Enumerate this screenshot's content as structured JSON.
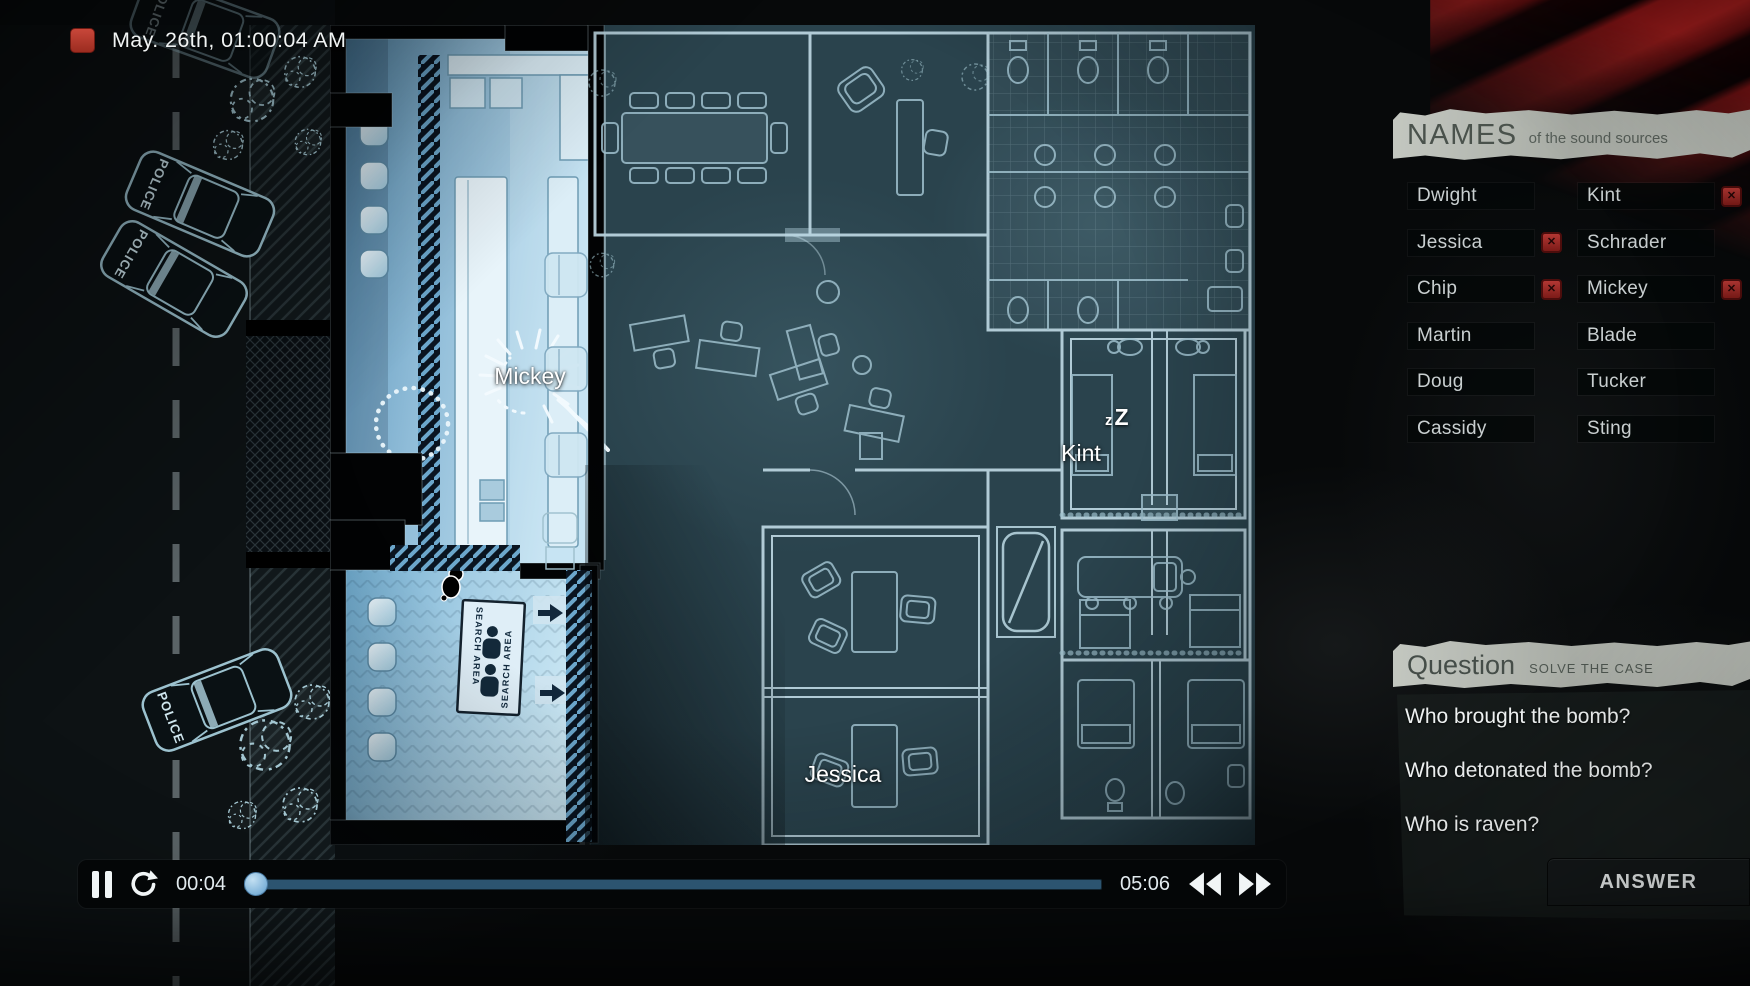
{
  "hud": {
    "timestamp": "May. 26th, 01:00:04 AM"
  },
  "map": {
    "police_text": "POLICE",
    "search_area_text": "SEARCH AREA",
    "labels": {
      "mickey": "Mickey",
      "kint": "Kint",
      "jessica": "Jessica"
    },
    "sleep_small": "z",
    "sleep_big": "Z"
  },
  "names_panel": {
    "title": "NAMES",
    "subtitle": "of the sound sources",
    "flag_icon": "✕",
    "items": [
      {
        "label": "Dwight",
        "flagged": false
      },
      {
        "label": "Kint",
        "flagged": true
      },
      {
        "label": "Jessica",
        "flagged": true
      },
      {
        "label": "Schrader",
        "flagged": false
      },
      {
        "label": "Chip",
        "flagged": true
      },
      {
        "label": "Mickey",
        "flagged": true
      },
      {
        "label": "Martin",
        "flagged": false
      },
      {
        "label": "Blade",
        "flagged": false
      },
      {
        "label": "Doug",
        "flagged": false
      },
      {
        "label": "Tucker",
        "flagged": false
      },
      {
        "label": "Cassidy",
        "flagged": false
      },
      {
        "label": "Sting",
        "flagged": false
      }
    ]
  },
  "question_panel": {
    "title": "Question",
    "subtitle": "SOLVE THE CASE",
    "questions": [
      "Who brought the bomb?",
      "Who detonated the bomb?",
      "Who is raven?"
    ],
    "answer_label": "ANSWER"
  },
  "player": {
    "current_time": "00:04",
    "total_time": "05:06",
    "progress_percent": 1.3
  },
  "colors": {
    "accent_red": "#9c2c20",
    "blueprint_line": "#a7c6d2",
    "lit_room": "#9fc9e0",
    "track_blue": "#2c5470",
    "knob_blue": "#85bade"
  }
}
